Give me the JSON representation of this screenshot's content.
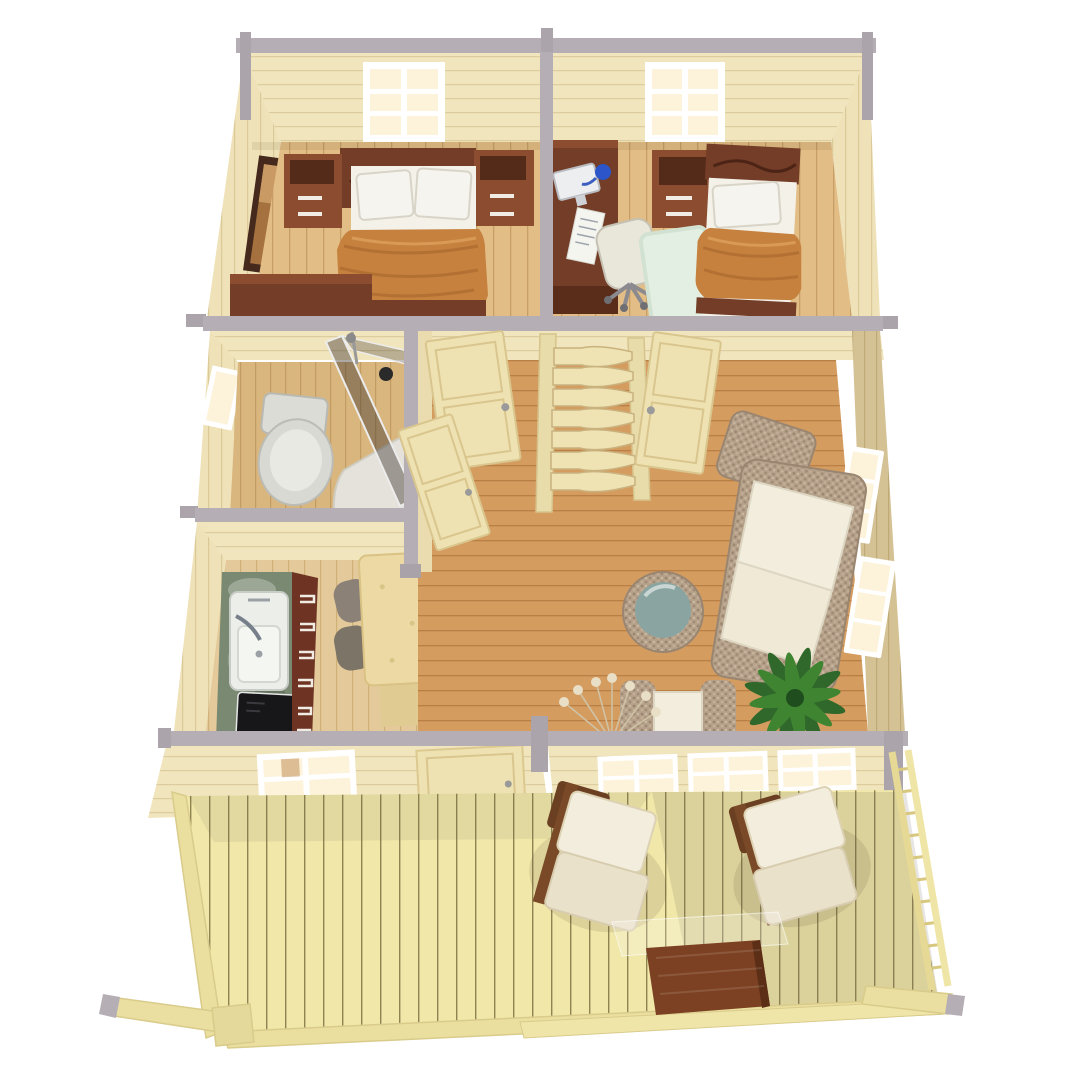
{
  "canvas": {
    "width": 1080,
    "height": 1080
  },
  "scene": {
    "type": "3d-architectural-floor-plan-render",
    "view": "top-down cutaway perspective",
    "building": "single-storey wooden cabin with front deck",
    "rooms": [
      {
        "name": "bedroom-double",
        "furniture": [
          "double-bed",
          "headboard",
          "nightstand-left",
          "nightstand-right",
          "orange-blanket",
          "pillows",
          "wall-picture",
          "dresser",
          "back-window"
        ]
      },
      {
        "name": "bedroom-single",
        "furniture": [
          "single-bed",
          "orange-blanket",
          "pillow",
          "desk",
          "monitor",
          "desk-lamp",
          "office-chair",
          "nightstand",
          "rug",
          "back-window"
        ]
      },
      {
        "name": "bathroom",
        "furniture": [
          "toilet",
          "corner-shower",
          "shower-glass",
          "side-window"
        ]
      },
      {
        "name": "kitchen",
        "furniture": [
          "marble-counter",
          "sink",
          "cooktop",
          "drawer-cabinet",
          "dining-table",
          "chairs"
        ]
      },
      {
        "name": "hallway",
        "furniture": [
          "shelf-stairs",
          "door-bedroom-1",
          "door-bedroom-2",
          "door-bathroom"
        ]
      },
      {
        "name": "living-room",
        "furniture": [
          "wicker-sofa",
          "wicker-pillow",
          "glass-top-ottoman",
          "armchair",
          "palm-plant",
          "twig-decor",
          "side-windows"
        ]
      },
      {
        "name": "deck",
        "furniture": [
          "lounger-left",
          "lounger-right",
          "coffee-table",
          "railing",
          "corner-beams",
          "front-door",
          "front-window",
          "glazed-wall"
        ]
      }
    ]
  },
  "colors": {
    "background": "#ffffff",
    "cap_gray": "#b5afb5",
    "cap_gray_dark": "#a49ea5",
    "wall_cream": "#f1e5bd",
    "wall_line": "#ddcc9d",
    "wall_olive": "#d5c294",
    "wall_olive_line": "#bfa977",
    "floor_bedroom": "#e2bd85",
    "floor_bedroom_line": "#c79e66",
    "floor_bath": "#d9b67e",
    "floor_bath_line": "#c19c63",
    "floor_hall": "#d59c60",
    "floor_hall_line": "#b97f45",
    "floor_kitchen": "#e4ca9b",
    "floor_kitchen_line": "#cfb077",
    "floor_deck": "#f0e7a9",
    "floor_deck_line": "#8f8352",
    "walnut": "#733d27",
    "walnut_dark": "#5a2d1b",
    "walnut_light": "#8c4c30",
    "blanket_orange": "#c5813d",
    "bedding_white": "#f4f1e9",
    "wicker": "#b6a28b",
    "wicker_dark": "#9a8670",
    "cushion_ivory": "#f2eddd",
    "palm_green": "#30682b",
    "palm_green_light": "#3f8431",
    "ottoman_glass": "#8aa5a1",
    "marble_green": "#7a8a72",
    "appliance_black": "#17171a",
    "window_glow": "#fdf3da",
    "window_frame": "#ffffff",
    "rug_mint": "#e3efe3",
    "chair_gray": "#8b8176",
    "door_wood": "#efe2b2",
    "door_line": "#d9c68e",
    "table_mahogany": "#7c4122",
    "deck_edge_wood": "#ebdfa0",
    "toilet_white": "#dcdcd6"
  }
}
